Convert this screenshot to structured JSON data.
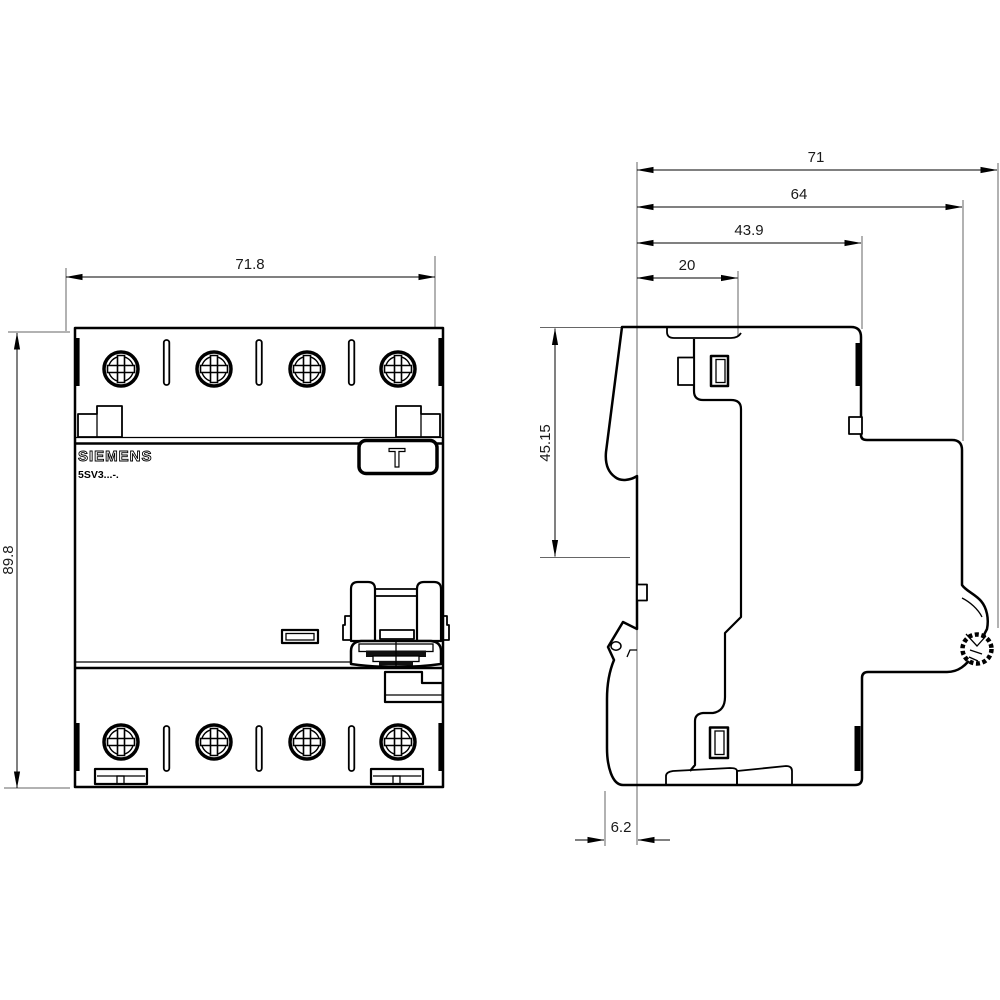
{
  "front_view": {
    "brand": "SIEMENS",
    "model": "5SV3...-.",
    "test_button": "T",
    "dim_width": "71.8",
    "dim_height": "89.8"
  },
  "side_view": {
    "dim_overall_depth": "71",
    "dim_depth_without_clip": "64",
    "dim_front_to_din_rail": "43.9",
    "dim_terminal_recess_depth": "20",
    "dim_top_to_din_center": "45.15",
    "dim_handle_protrusion": "6.2"
  }
}
